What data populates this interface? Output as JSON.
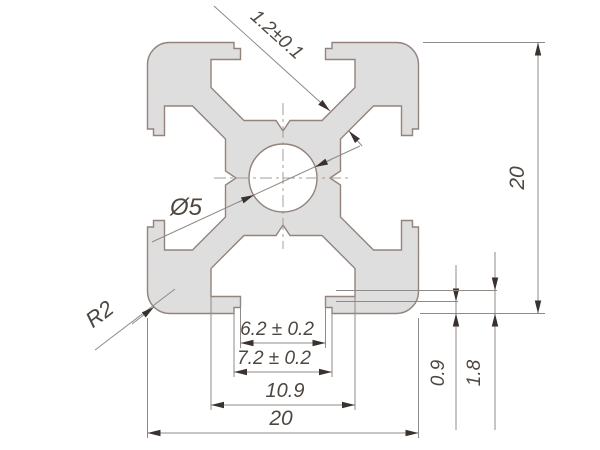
{
  "labels": {
    "web_thickness": "1.2±0.1",
    "hole_diameter": "Ø5",
    "corner_radius": "R2",
    "slot_opening": "6.2 ± 0.2",
    "slot_throat": "7.2 ± 0.2",
    "slot_width": "10.9",
    "overall_width": "20",
    "overall_height": "20",
    "lip_offset": "0.9",
    "ledge_offset": "1.8"
  },
  "colors": {
    "background": "#ffffff",
    "profile_fill": "#dedede",
    "profile_stroke": "#93837c",
    "dimension_line": "#8f8a86",
    "centerline": "#a59c94",
    "arrow": "#39322e",
    "text": "#4e4741"
  }
}
